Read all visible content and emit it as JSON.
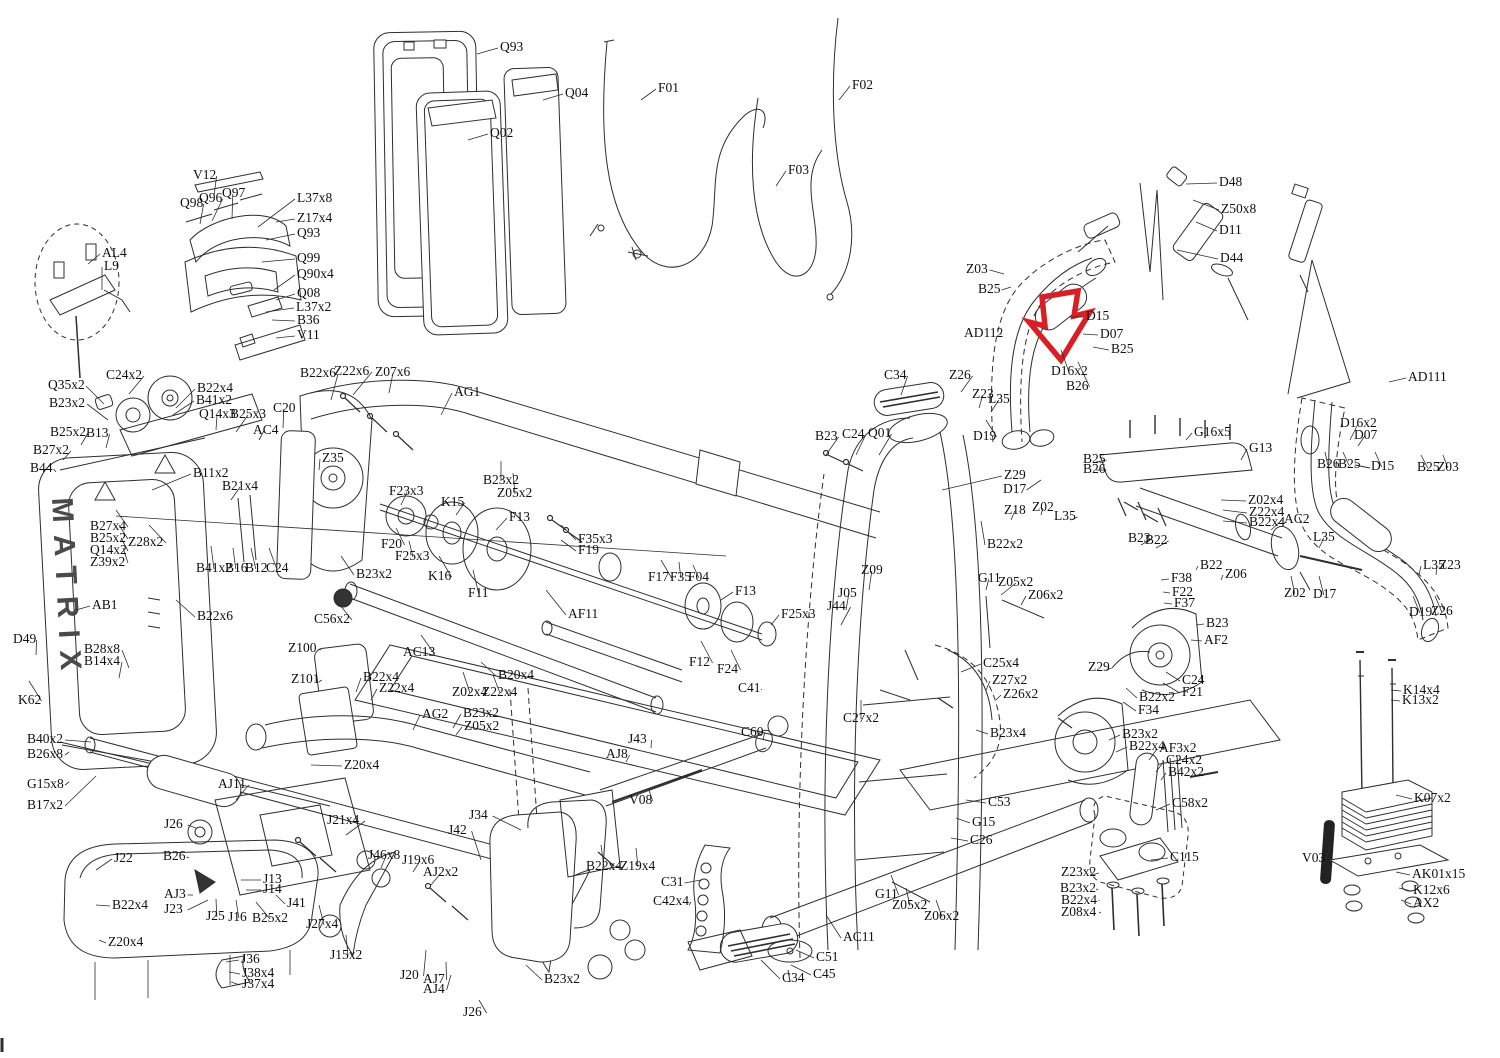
{
  "brand_vertical": "MATRIX",
  "highlight": {
    "color": "#d81f26",
    "shape": "down-arrow"
  },
  "line_color": "#2e2e2e",
  "labels": [
    [
      "V12",
      193,
      168,
      214,
      196
    ],
    [
      "Q98",
      180,
      196,
      200,
      224
    ],
    [
      "Q96",
      199,
      191,
      212,
      221
    ],
    [
      "Q97",
      222,
      186,
      232,
      219
    ],
    [
      "L37x8",
      297,
      191,
      258,
      227
    ],
    [
      "Z17x4",
      297,
      211,
      276,
      222
    ],
    [
      "Q93",
      297,
      226,
      266,
      240
    ],
    [
      "Q99",
      297,
      251,
      262,
      262
    ],
    [
      "Q90x4",
      297,
      267,
      274,
      290
    ],
    [
      "Q08",
      297,
      286,
      276,
      300
    ],
    [
      "L37x2",
      296,
      300,
      266,
      312
    ],
    [
      "B36",
      297,
      313,
      272,
      320
    ],
    [
      "V11",
      297,
      328,
      276,
      338
    ],
    [
      "AL4",
      102,
      246,
      88,
      264
    ],
    [
      "L9",
      104,
      259,
      102,
      290
    ],
    [
      "Q93",
      500,
      40,
      477,
      54
    ],
    [
      "Q02",
      490,
      126,
      468,
      140
    ],
    [
      "Q04",
      565,
      86,
      543,
      100
    ],
    [
      "F01",
      658,
      81,
      641,
      100
    ],
    [
      "F03",
      788,
      163,
      776,
      186
    ],
    [
      "F02",
      852,
      78,
      839,
      100
    ],
    [
      "D48",
      1219,
      175,
      1186,
      184
    ],
    [
      "Z50x8",
      1221,
      202,
      1193,
      200
    ],
    [
      "D11",
      1219,
      223,
      1196,
      222
    ],
    [
      "D44",
      1220,
      251,
      1177,
      250
    ],
    [
      "Z03",
      966,
      262,
      1004,
      274
    ],
    [
      "B25",
      978,
      282,
      1011,
      287
    ],
    [
      "AD112",
      964,
      326,
      1000,
      334
    ],
    [
      "D15",
      1086,
      309,
      1069,
      317
    ],
    [
      "D07",
      1100,
      327,
      1083,
      334
    ],
    [
      "B25",
      1111,
      342,
      1093,
      347
    ],
    [
      "D16x2",
      1051,
      364,
      1061,
      350
    ],
    [
      "B26",
      1066,
      379,
      1078,
      362
    ],
    [
      "AD111",
      1408,
      370,
      1389,
      382
    ],
    [
      "D16x2",
      1340,
      416,
      1350,
      440
    ],
    [
      "D07",
      1354,
      428,
      1358,
      446
    ],
    [
      "B26",
      1317,
      457,
      1325,
      452
    ],
    [
      "B25",
      1338,
      457,
      1343,
      452
    ],
    [
      "D15",
      1371,
      459,
      1375,
      452
    ],
    [
      "B25",
      1417,
      460,
      1421,
      455
    ],
    [
      "Z03",
      1437,
      460,
      1443,
      455
    ],
    [
      "C24x2",
      106,
      368,
      129,
      394
    ],
    [
      "Q35x2",
      48,
      378,
      104,
      404
    ],
    [
      "B23x2",
      49,
      396,
      108,
      420
    ],
    [
      "B22x4",
      197,
      381,
      176,
      408
    ],
    [
      "B41x2",
      196,
      393,
      173,
      415
    ],
    [
      "Q14x3",
      199,
      407,
      216,
      430
    ],
    [
      "B25x3",
      230,
      407,
      236,
      432
    ],
    [
      "C20",
      273,
      401,
      283,
      428
    ],
    [
      "AC4",
      253,
      423,
      259,
      440
    ],
    [
      "B25x2",
      50,
      425,
      81,
      445
    ],
    [
      "B13",
      86,
      426,
      106,
      448
    ],
    [
      "B27x2",
      33,
      443,
      63,
      460
    ],
    [
      "B44",
      30,
      461,
      56,
      472
    ],
    [
      "B11x2",
      193,
      466,
      152,
      490
    ],
    [
      "B21x4",
      222,
      479,
      231,
      500
    ],
    [
      "B27x4",
      90,
      519,
      116,
      510
    ],
    [
      "B25x2",
      90,
      531,
      119,
      525
    ],
    [
      "Q14x2",
      90,
      543,
      121,
      538
    ],
    [
      "Z39x2",
      90,
      555,
      123,
      548
    ],
    [
      "Z28x2",
      128,
      535,
      149,
      525
    ],
    [
      "B41x2",
      196,
      561,
      211,
      546
    ],
    [
      "B16",
      225,
      561,
      233,
      548
    ],
    [
      "B12",
      245,
      561,
      251,
      548
    ],
    [
      "C24",
      266,
      561,
      269,
      548
    ],
    [
      "AB1",
      92,
      598,
      76,
      610
    ],
    [
      "B22x6",
      300,
      366,
      331,
      400
    ],
    [
      "Z22x6",
      334,
      364,
      353,
      395
    ],
    [
      "Z07x6",
      375,
      365,
      389,
      393
    ],
    [
      "AG1",
      454,
      385,
      441,
      415
    ],
    [
      "Z35",
      322,
      451,
      319,
      470
    ],
    [
      "F23x3",
      389,
      484,
      401,
      505
    ],
    [
      "K15",
      441,
      495,
      456,
      515
    ],
    [
      "F13",
      509,
      510,
      496,
      530
    ],
    [
      "B23x2",
      483,
      473,
      501,
      461
    ],
    [
      "Z05x2",
      497,
      486,
      513,
      473
    ],
    [
      "F20",
      381,
      537,
      396,
      528
    ],
    [
      "F25x3",
      395,
      549,
      409,
      541
    ],
    [
      "K16",
      428,
      569,
      439,
      556
    ],
    [
      "F11",
      468,
      586,
      473,
      570
    ],
    [
      "B23x2",
      356,
      567,
      341,
      556
    ],
    [
      "F35x3",
      578,
      532,
      561,
      525
    ],
    [
      "F19",
      578,
      543,
      561,
      540
    ],
    [
      "F17",
      648,
      570,
      661,
      560
    ],
    [
      "F35",
      670,
      570,
      679,
      562
    ],
    [
      "F04",
      688,
      570,
      693,
      565
    ],
    [
      "F13",
      735,
      584,
      721,
      600
    ],
    [
      "F25x3",
      781,
      607,
      771,
      625
    ],
    [
      "J05",
      838,
      586,
      846,
      610
    ],
    [
      "J44",
      827,
      599,
      841,
      625
    ],
    [
      "AF11",
      568,
      607,
      546,
      590
    ],
    [
      "F12",
      689,
      655,
      701,
      641
    ],
    [
      "F24",
      717,
      662,
      731,
      650
    ],
    [
      "C41",
      738,
      681,
      761,
      690
    ],
    [
      "Z09",
      861,
      563,
      869,
      590
    ],
    [
      "C34",
      884,
      368,
      901,
      395
    ],
    [
      "Z26",
      949,
      368,
      961,
      392
    ],
    [
      "Z23",
      972,
      387,
      979,
      408
    ],
    [
      "L35",
      988,
      392,
      991,
      412
    ],
    [
      "D19",
      973,
      429,
      986,
      420
    ],
    [
      "B23",
      815,
      429,
      826,
      455
    ],
    [
      "C24",
      842,
      427,
      856,
      455
    ],
    [
      "Q01",
      868,
      426,
      879,
      455
    ],
    [
      "Z29",
      1004,
      468,
      942,
      490
    ],
    [
      "D17",
      1003,
      482,
      1041,
      480
    ],
    [
      "Z18",
      1004,
      503,
      1011,
      520
    ],
    [
      "Z02",
      1032,
      500,
      1041,
      515
    ],
    [
      "B22x2",
      987,
      537,
      981,
      521
    ],
    [
      "L35",
      1054,
      509,
      1071,
      520
    ],
    [
      "B25",
      1083,
      452,
      1096,
      462
    ],
    [
      "B26",
      1083,
      462,
      1096,
      470
    ],
    [
      "G16x5",
      1194,
      425,
      1186,
      440
    ],
    [
      "G13",
      1249,
      441,
      1241,
      460
    ],
    [
      "Z02x4",
      1248,
      493,
      1221,
      500
    ],
    [
      "Z22x4",
      1249,
      505,
      1223,
      510
    ],
    [
      "B22x4",
      1249,
      515,
      1223,
      521
    ],
    [
      "AC2",
      1284,
      512,
      1271,
      530
    ],
    [
      "B23",
      1128,
      531,
      1141,
      545
    ],
    [
      "B22",
      1145,
      533,
      1156,
      548
    ],
    [
      "B22",
      1200,
      558,
      1196,
      570
    ],
    [
      "Z06",
      1225,
      567,
      1221,
      580
    ],
    [
      "L35",
      1313,
      530,
      1319,
      548
    ],
    [
      "Z02",
      1284,
      586,
      1291,
      576
    ],
    [
      "D17",
      1313,
      587,
      1319,
      576
    ],
    [
      "L35",
      1423,
      558,
      1419,
      575
    ],
    [
      "Z23",
      1439,
      558,
      1436,
      575
    ],
    [
      "D19",
      1409,
      605,
      1413,
      596
    ],
    [
      "Z26",
      1431,
      604,
      1435,
      596
    ],
    [
      "F38",
      1171,
      571,
      1161,
      580
    ],
    [
      "F22",
      1172,
      585,
      1163,
      592
    ],
    [
      "F37",
      1174,
      596,
      1164,
      603
    ],
    [
      "B23",
      1206,
      616,
      1196,
      625
    ],
    [
      "AF2",
      1204,
      633,
      1191,
      640
    ],
    [
      "Z29",
      1088,
      660,
      1106,
      670
    ],
    [
      "C24",
      1182,
      673,
      1166,
      672
    ],
    [
      "F21",
      1182,
      685,
      1163,
      683
    ],
    [
      "B22x2",
      1139,
      690,
      1126,
      688
    ],
    [
      "F34",
      1138,
      703,
      1123,
      702
    ],
    [
      "D49",
      13,
      632,
      36,
      655
    ],
    [
      "B28x8",
      84,
      642,
      129,
      668
    ],
    [
      "B14x4",
      84,
      654,
      119,
      678
    ],
    [
      "K62",
      18,
      693,
      29,
      681
    ],
    [
      "B40x2",
      27,
      732,
      91,
      742
    ],
    [
      "B26x8",
      27,
      747,
      69,
      752
    ],
    [
      "G15x8",
      27,
      777,
      69,
      782
    ],
    [
      "B17x2",
      27,
      798,
      96,
      776
    ],
    [
      "B22x6",
      197,
      609,
      176,
      600
    ],
    [
      "J22",
      114,
      851,
      96,
      870
    ],
    [
      "B22x4",
      112,
      898,
      96,
      905
    ],
    [
      "Z20x4",
      108,
      935,
      99,
      940
    ],
    [
      "AJ11",
      218,
      777,
      236,
      800
    ],
    [
      "J26",
      164,
      817,
      196,
      828
    ],
    [
      "B26",
      163,
      849,
      189,
      858
    ],
    [
      "AJ3",
      164,
      887,
      193,
      895
    ],
    [
      "J23",
      164,
      902,
      208,
      900
    ],
    [
      "J25",
      206,
      909,
      216,
      899
    ],
    [
      "J16",
      228,
      910,
      236,
      900
    ],
    [
      "B25x2",
      252,
      911,
      256,
      902
    ],
    [
      "J13",
      263,
      872,
      241,
      880
    ],
    [
      "J14",
      263,
      882,
      246,
      890
    ],
    [
      "J41",
      287,
      896,
      276,
      895
    ],
    [
      "J36",
      241,
      952,
      226,
      962
    ],
    [
      "J38x4",
      242,
      966,
      229,
      972
    ],
    [
      "J37x4",
      242,
      977,
      231,
      982
    ],
    [
      "Z20x4",
      344,
      758,
      311,
      765
    ],
    [
      "J21x4",
      327,
      813,
      346,
      835
    ],
    [
      "J46x8",
      368,
      848,
      381,
      868
    ],
    [
      "J19x6",
      402,
      853,
      413,
      872
    ],
    [
      "AJ2x2",
      423,
      865,
      431,
      885
    ],
    [
      "J27x4",
      306,
      917,
      319,
      905
    ],
    [
      "J15x2",
      330,
      948,
      346,
      935
    ],
    [
      "J20",
      400,
      968,
      426,
      950
    ],
    [
      "AJ7",
      423,
      972,
      446,
      962
    ],
    [
      "AJ4",
      423,
      982,
      451,
      975
    ],
    [
      "J26",
      463,
      1005,
      479,
      1000
    ],
    [
      "B23x2",
      544,
      972,
      526,
      965
    ],
    [
      "J34",
      469,
      808,
      521,
      830
    ],
    [
      "J42",
      448,
      823,
      481,
      860
    ],
    [
      "AC13",
      403,
      645,
      421,
      635
    ],
    [
      "B20x4",
      498,
      668,
      481,
      662
    ],
    [
      "Z02x4",
      452,
      685,
      463,
      672
    ],
    [
      "Z22x4",
      482,
      685,
      493,
      675
    ],
    [
      "AG2",
      422,
      707,
      413,
      730
    ],
    [
      "B23x2",
      463,
      706,
      453,
      728
    ],
    [
      "Z05x2",
      464,
      719,
      456,
      735
    ],
    [
      "J43",
      628,
      732,
      651,
      748
    ],
    [
      "AJ8",
      606,
      747,
      626,
      762
    ],
    [
      "V08",
      629,
      793,
      649,
      790
    ],
    [
      "B22x4",
      586,
      859,
      601,
      845
    ],
    [
      "Z19x4",
      620,
      859,
      636,
      848
    ],
    [
      "C56x2",
      314,
      612,
      336,
      600
    ],
    [
      "Z100",
      288,
      641,
      321,
      650
    ],
    [
      "Z101",
      291,
      672,
      319,
      682
    ],
    [
      "B22x4",
      363,
      670,
      356,
      692
    ],
    [
      "Z22x4",
      379,
      681,
      371,
      700
    ],
    [
      "C31",
      661,
      875,
      701,
      880
    ],
    [
      "C42x4",
      653,
      894,
      689,
      905
    ],
    [
      "C34",
      782,
      971,
      761,
      960
    ],
    [
      "AC11",
      843,
      930,
      826,
      915
    ],
    [
      "C51",
      816,
      950,
      796,
      950
    ],
    [
      "C45",
      813,
      967,
      791,
      965
    ],
    [
      "C60",
      741,
      725,
      763,
      740
    ],
    [
      "C27x2",
      843,
      711,
      861,
      700
    ],
    [
      "C25x4",
      983,
      656,
      961,
      672
    ],
    [
      "Z27x2",
      992,
      673,
      986,
      690
    ],
    [
      "Z26x2",
      1003,
      687,
      996,
      700
    ],
    [
      "B23x4",
      990,
      726,
      976,
      730
    ],
    [
      "C53",
      988,
      795,
      966,
      800
    ],
    [
      "G15",
      972,
      815,
      956,
      818
    ],
    [
      "C26",
      970,
      833,
      951,
      838
    ],
    [
      "G11",
      875,
      887,
      891,
      875
    ],
    [
      "Z05x2",
      892,
      898,
      906,
      888
    ],
    [
      "Z06x2",
      924,
      909,
      936,
      900
    ],
    [
      "G11",
      978,
      571,
      986,
      590
    ],
    [
      "Z05x2",
      998,
      575,
      1001,
      595
    ],
    [
      "Z06x2",
      1028,
      588,
      1021,
      605
    ],
    [
      "C115",
      1170,
      850,
      1151,
      860
    ],
    [
      "Z23x2",
      1061,
      865,
      1091,
      875
    ],
    [
      "B23x2",
      1060,
      881,
      1096,
      890
    ],
    [
      "B22x4",
      1061,
      893,
      1099,
      900
    ],
    [
      "Z08x4",
      1061,
      905,
      1101,
      912
    ],
    [
      "B23x2",
      1122,
      727,
      1109,
      740
    ],
    [
      "B22x4",
      1129,
      739,
      1116,
      752
    ],
    [
      "AF3x2",
      1159,
      741,
      1149,
      760
    ],
    [
      "C24x2",
      1166,
      753,
      1156,
      772
    ],
    [
      "B42x2",
      1168,
      765,
      1161,
      780
    ],
    [
      "C58x2",
      1172,
      796,
      1156,
      810
    ],
    [
      "K14x4",
      1403,
      683,
      1391,
      690
    ],
    [
      "K13x2",
      1402,
      693,
      1391,
      700
    ],
    [
      "K07x2",
      1414,
      791,
      1396,
      795
    ],
    [
      "V03",
      1302,
      851,
      1331,
      845
    ],
    [
      "AK01x15",
      1412,
      867,
      1396,
      872
    ],
    [
      "K12x6",
      1413,
      883,
      1399,
      888
    ],
    [
      "AX2",
      1413,
      896,
      1401,
      900
    ]
  ]
}
